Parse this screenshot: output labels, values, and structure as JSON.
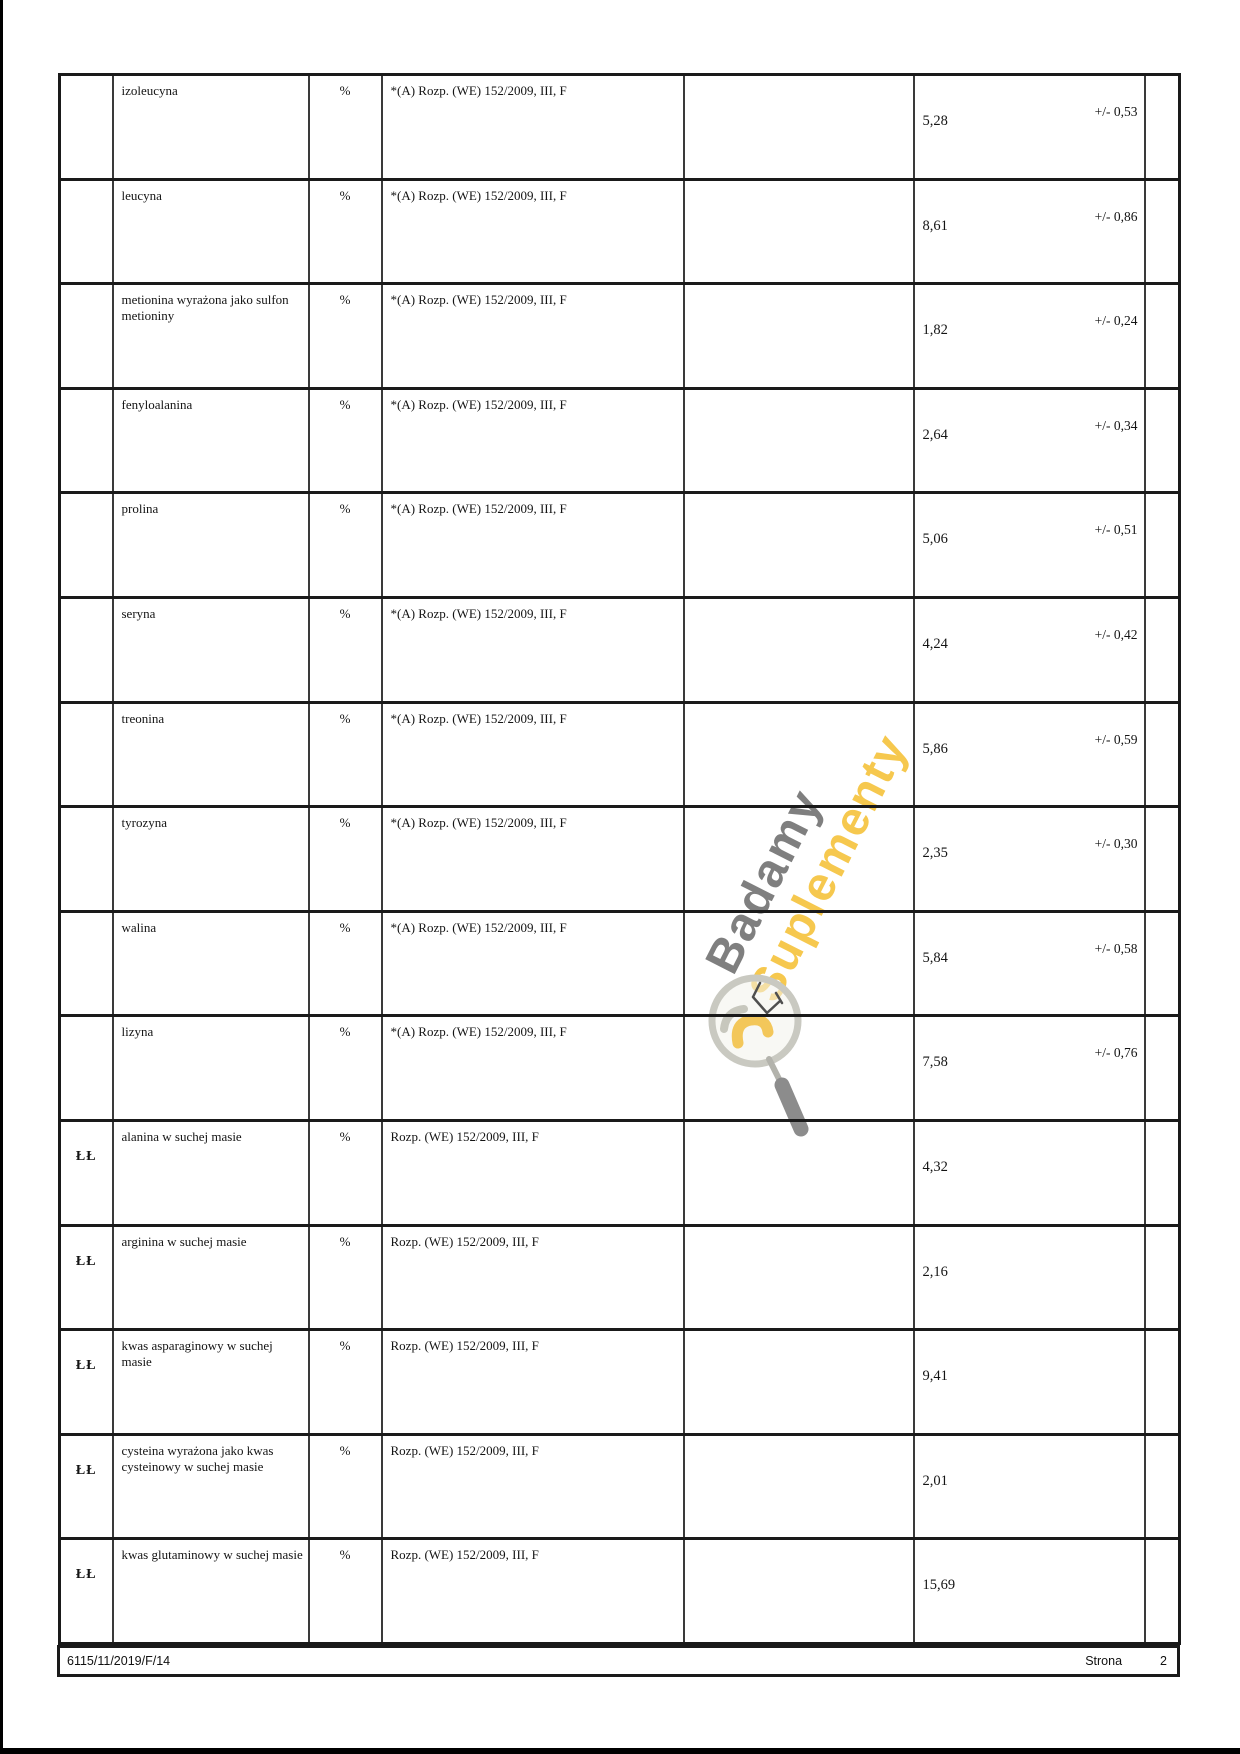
{
  "table": {
    "columns": [
      "label",
      "parameter",
      "unit",
      "method",
      "empty",
      "result",
      "empty-narrow"
    ],
    "rows": [
      {
        "label": "",
        "parameter": "izoleucyna",
        "unit": "%",
        "method": "*(A) Rozp. (WE) 152/2009, III, F",
        "value": "5,28",
        "uncertainty": "+/- 0,53"
      },
      {
        "label": "",
        "parameter": "leucyna",
        "unit": "%",
        "method": "*(A) Rozp. (WE) 152/2009, III, F",
        "value": "8,61",
        "uncertainty": "+/- 0,86"
      },
      {
        "label": "",
        "parameter": "metionina wyrażona jako sulfon\nmetioniny",
        "unit": "%",
        "method": "*(A) Rozp. (WE) 152/2009, III, F",
        "value": "1,82",
        "uncertainty": "+/- 0,24"
      },
      {
        "label": "",
        "parameter": "fenyloalanina",
        "unit": "%",
        "method": "*(A) Rozp. (WE) 152/2009, III, F",
        "value": "2,64",
        "uncertainty": "+/- 0,34"
      },
      {
        "label": "",
        "parameter": "prolina",
        "unit": "%",
        "method": "*(A) Rozp. (WE) 152/2009, III, F",
        "value": "5,06",
        "uncertainty": "+/- 0,51"
      },
      {
        "label": "",
        "parameter": "seryna",
        "unit": "%",
        "method": "*(A) Rozp. (WE) 152/2009, III, F",
        "value": "4,24",
        "uncertainty": "+/- 0,42"
      },
      {
        "label": "",
        "parameter": "treonina",
        "unit": "%",
        "method": "*(A) Rozp. (WE) 152/2009, III, F",
        "value": "5,86",
        "uncertainty": "+/- 0,59"
      },
      {
        "label": "",
        "parameter": "tyrozyna",
        "unit": "%",
        "method": "*(A) Rozp. (WE) 152/2009, III, F",
        "value": "2,35",
        "uncertainty": "+/- 0,30"
      },
      {
        "label": "",
        "parameter": "walina",
        "unit": "%",
        "method": "*(A) Rozp. (WE) 152/2009, III, F",
        "value": "5,84",
        "uncertainty": "+/- 0,58"
      },
      {
        "label": "",
        "parameter": "lizyna",
        "unit": "%",
        "method": "*(A) Rozp. (WE) 152/2009, III, F",
        "value": "7,58",
        "uncertainty": "+/- 0,76"
      },
      {
        "label": "ŁŁ",
        "parameter": "alanina w suchej masie",
        "unit": "%",
        "method": "Rozp. (WE) 152/2009, III, F",
        "value": "4,32",
        "uncertainty": ""
      },
      {
        "label": "ŁŁ",
        "parameter": "arginina w suchej masie",
        "unit": "%",
        "method": "Rozp. (WE) 152/2009, III, F",
        "value": "2,16",
        "uncertainty": ""
      },
      {
        "label": "ŁŁ",
        "parameter": "kwas asparaginowy w suchej\nmasie",
        "unit": "%",
        "method": "Rozp. (WE) 152/2009, III, F",
        "value": "9,41",
        "uncertainty": ""
      },
      {
        "label": "ŁŁ",
        "parameter": "cysteina wyrażona jako kwas\ncysteinowy w suchej masie",
        "unit": "%",
        "method": "Rozp. (WE) 152/2009, III, F",
        "value": "2,01",
        "uncertainty": ""
      },
      {
        "label": "ŁŁ",
        "parameter": "kwas glutaminowy w suchej masie",
        "unit": "%",
        "method": "Rozp. (WE) 152/2009, III, F",
        "value": "15,69",
        "uncertainty": ""
      }
    ]
  },
  "watermark": {
    "line1": "Badamy",
    "line2": "Suplementy",
    "icon": "magnifier-bulb-logo",
    "colors": {
      "line1": "#7f7f7f",
      "line2": "#f6c84e"
    }
  },
  "footer": {
    "document_number": "6115/11/2019/F/14",
    "page_label": "Strona",
    "page_number": "2"
  }
}
